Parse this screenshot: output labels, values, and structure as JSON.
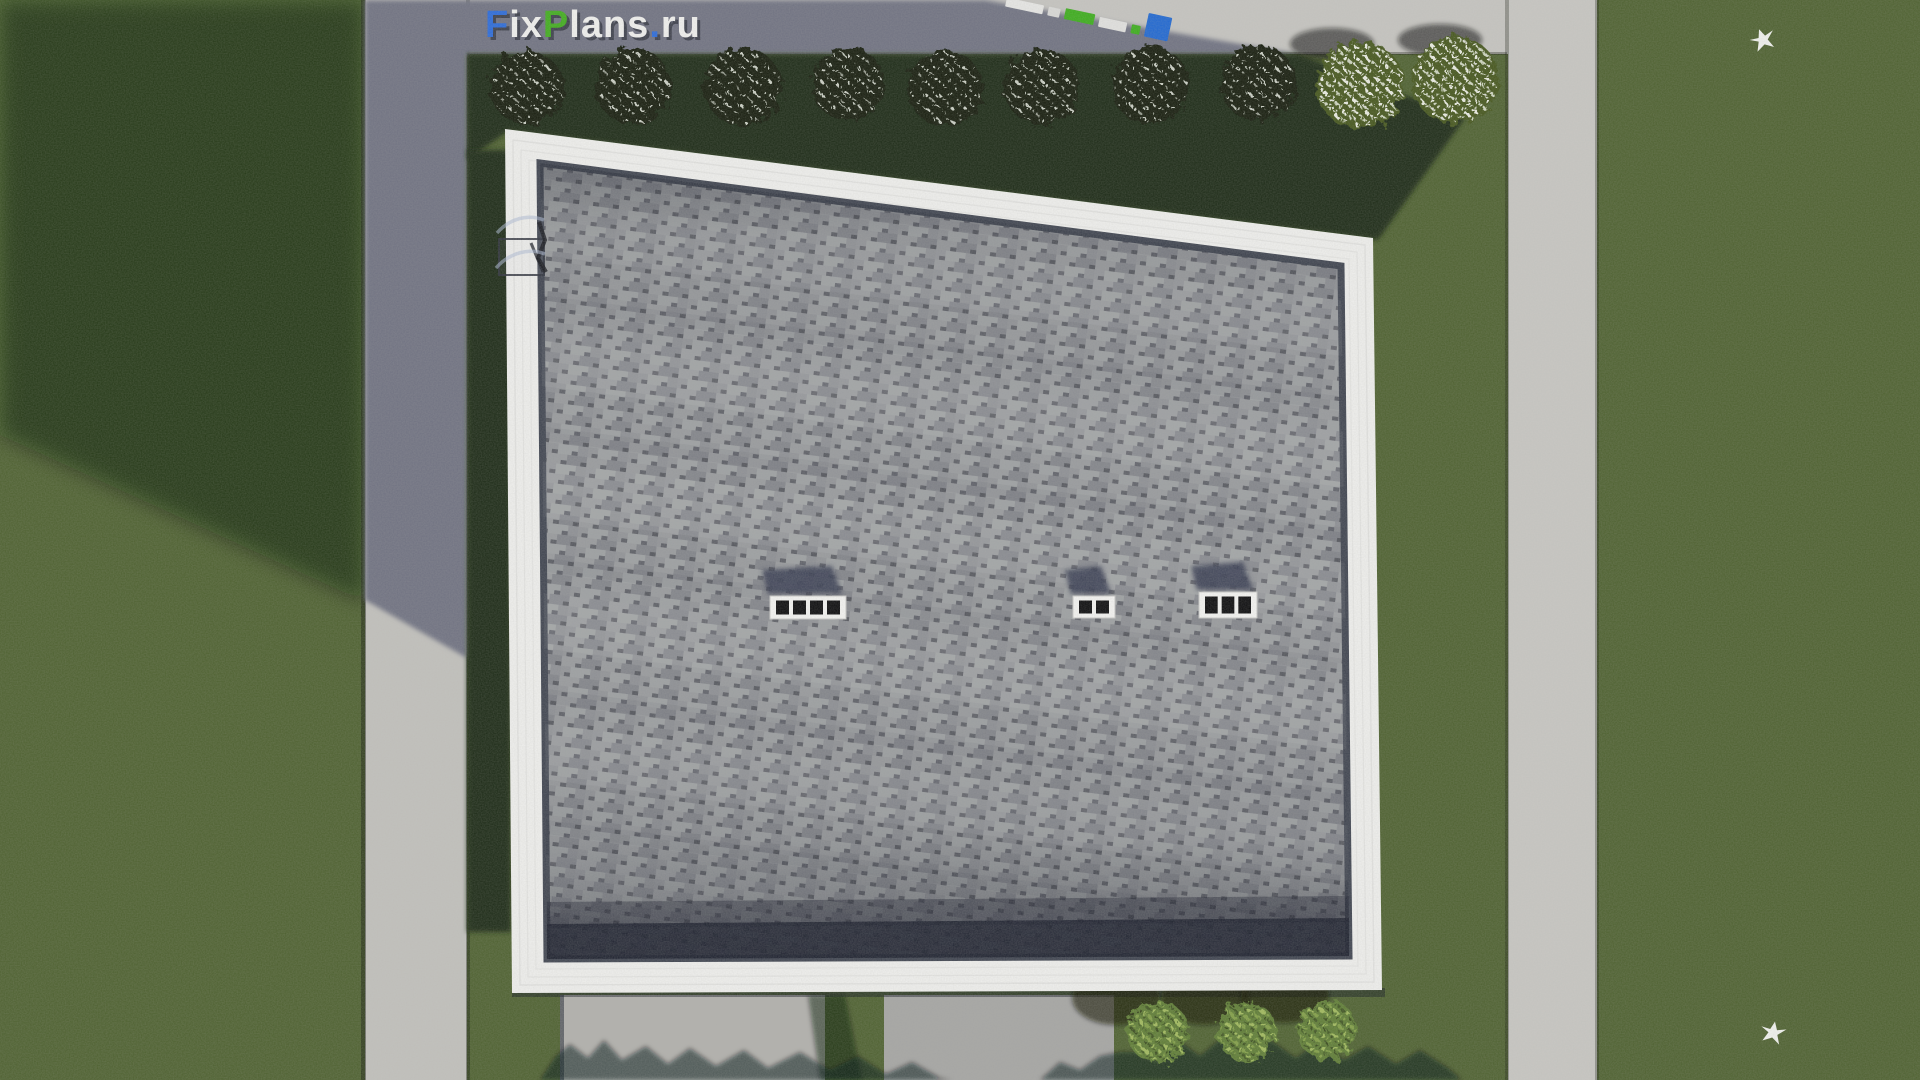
{
  "meta": {
    "title": "Top-down architectural site render with shingled roof"
  },
  "watermark": {
    "segments": [
      {
        "text": "F",
        "color": "#2b6bdb"
      },
      {
        "text": "ix",
        "color": "#f1f1ef"
      },
      {
        "text": "P",
        "color": "#41ad1e"
      },
      {
        "text": "lans",
        "color": "#f1f1ef"
      },
      {
        "text": ".",
        "color": "#2b6bdb"
      },
      {
        "text": "ru",
        "color": "#f1f1ef"
      }
    ]
  },
  "palette": {
    "grass_lit": "#4e6130",
    "grass_shadow": "#1e2912",
    "concrete_lit": "#c6c5c1",
    "concrete_shadow": "#6f7282",
    "roof_fascia": "#f0f0ee",
    "shingle_light": "#989a9d",
    "shingle_mid": "#8a8c90",
    "shingle_dark": "#5d5f66",
    "eave_dark": "#1b1f2d",
    "vent_white": "#f4f4f2",
    "vent_hole": "#0c0c0e",
    "shadow_navy": "#3a4154",
    "bush_shaded": "#141c0c",
    "bush_sunlit": "#45571f",
    "garden_bush": "#5f7d35",
    "bird_white": "#f2f3f0"
  },
  "scene": {
    "hedge_bushes": [
      {
        "x": 527,
        "y": 88,
        "r": 37,
        "variant": "shaded"
      },
      {
        "x": 633,
        "y": 86,
        "r": 38,
        "variant": "shaded"
      },
      {
        "x": 743,
        "y": 87,
        "r": 39,
        "variant": "shaded"
      },
      {
        "x": 848,
        "y": 84,
        "r": 37,
        "variant": "shaded"
      },
      {
        "x": 945,
        "y": 88,
        "r": 38,
        "variant": "shaded"
      },
      {
        "x": 1042,
        "y": 87,
        "r": 38,
        "variant": "shaded"
      },
      {
        "x": 1150,
        "y": 85,
        "r": 39,
        "variant": "shaded"
      },
      {
        "x": 1258,
        "y": 83,
        "r": 38,
        "variant": "shaded"
      },
      {
        "x": 1360,
        "y": 85,
        "r": 44,
        "variant": "sunlit"
      },
      {
        "x": 1455,
        "y": 80,
        "r": 44,
        "variant": "sunlit"
      }
    ],
    "hedge_bush_shadows": [
      {
        "cx": 1332,
        "cy": 44,
        "rx": 42,
        "ry": 16
      },
      {
        "cx": 1440,
        "cy": 40,
        "rx": 42,
        "ry": 16
      }
    ],
    "garden_bushes": [
      {
        "x": 1158,
        "y": 1032,
        "r": 31
      },
      {
        "x": 1247,
        "y": 1032,
        "r": 30
      },
      {
        "x": 1327,
        "y": 1030,
        "r": 30
      }
    ],
    "roof_vents": [
      {
        "x": 770,
        "y": 596,
        "w": 76,
        "h": 23,
        "holes": 4
      },
      {
        "x": 1073,
        "y": 596,
        "w": 42,
        "h": 22,
        "holes": 2
      },
      {
        "x": 1199,
        "y": 592,
        "w": 58,
        "h": 26,
        "holes": 3
      }
    ],
    "birds": [
      {
        "x": 1763,
        "y": 40,
        "rot": -20
      },
      {
        "x": 1773,
        "y": 1033,
        "rot": 10
      }
    ],
    "marker_strip": {
      "x": 1006,
      "y": 2,
      "angle": 12,
      "gap": 5,
      "segments": [
        {
          "w": 38,
          "h": 9,
          "dy": 0,
          "color": "#e8e8e6"
        },
        {
          "w": 12,
          "h": 9,
          "dy": 0,
          "color": "#dadad8"
        },
        {
          "w": 30,
          "h": 11,
          "dy": -1,
          "color": "#3cae1c"
        },
        {
          "w": 28,
          "h": 10,
          "dy": 0,
          "color": "#e2e2e0"
        },
        {
          "w": 9,
          "h": 9,
          "dy": 0,
          "color": "#3cae1c"
        },
        {
          "w": 24,
          "h": 24,
          "dy": -7,
          "color": "#2068d2"
        }
      ]
    }
  }
}
